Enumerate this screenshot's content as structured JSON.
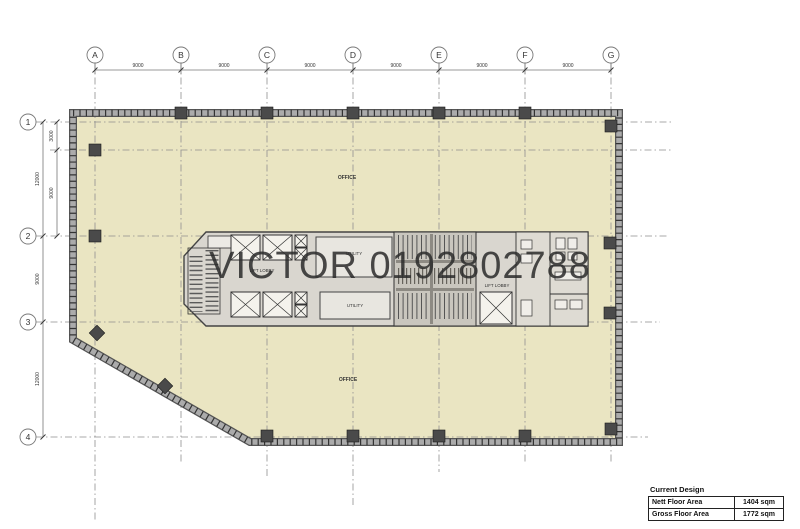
{
  "watermark": "VICTOR 0192802788",
  "grid": {
    "columns": [
      "A",
      "B",
      "C",
      "D",
      "E",
      "F",
      "G"
    ],
    "rows": [
      "1",
      "2",
      "3",
      "4"
    ],
    "column_spacings": [
      "9000",
      "9000",
      "9000",
      "9000",
      "9000",
      "9000"
    ],
    "row_dims": {
      "r1_sub": "3000",
      "sub_r2": "9000",
      "r1_r2": "12000",
      "r2_r3": "9000",
      "r3_r4": "12000"
    }
  },
  "labels": {
    "office_top": "OFFICE",
    "office_bottom": "OFFICE",
    "utility_top": "UTILITY",
    "utility_bottom": "UTILITY",
    "lift_lobby_high_line1": "LIFT LOBBY",
    "lift_lobby_high_line2": "(HIGH ZONE)",
    "lift_lobby_right": "LIFT LOBBY"
  },
  "summary": {
    "title": "Current Design",
    "rows": [
      {
        "label": "Nett Floor Area",
        "value": "1404 sqm"
      },
      {
        "label": "Gross Floor Area",
        "value": "1772 sqm"
      }
    ]
  },
  "colors": {
    "floor_fill": "#eae5c2",
    "core_fill": "#d9d6cf",
    "wall_band": "#a8a8a8",
    "wall_edge": "#555555",
    "hatch_tick": "#333333",
    "column_fill": "#4a4a4a",
    "grid_line": "#8f8f8f",
    "watermark_text": "#2b2b2b"
  }
}
